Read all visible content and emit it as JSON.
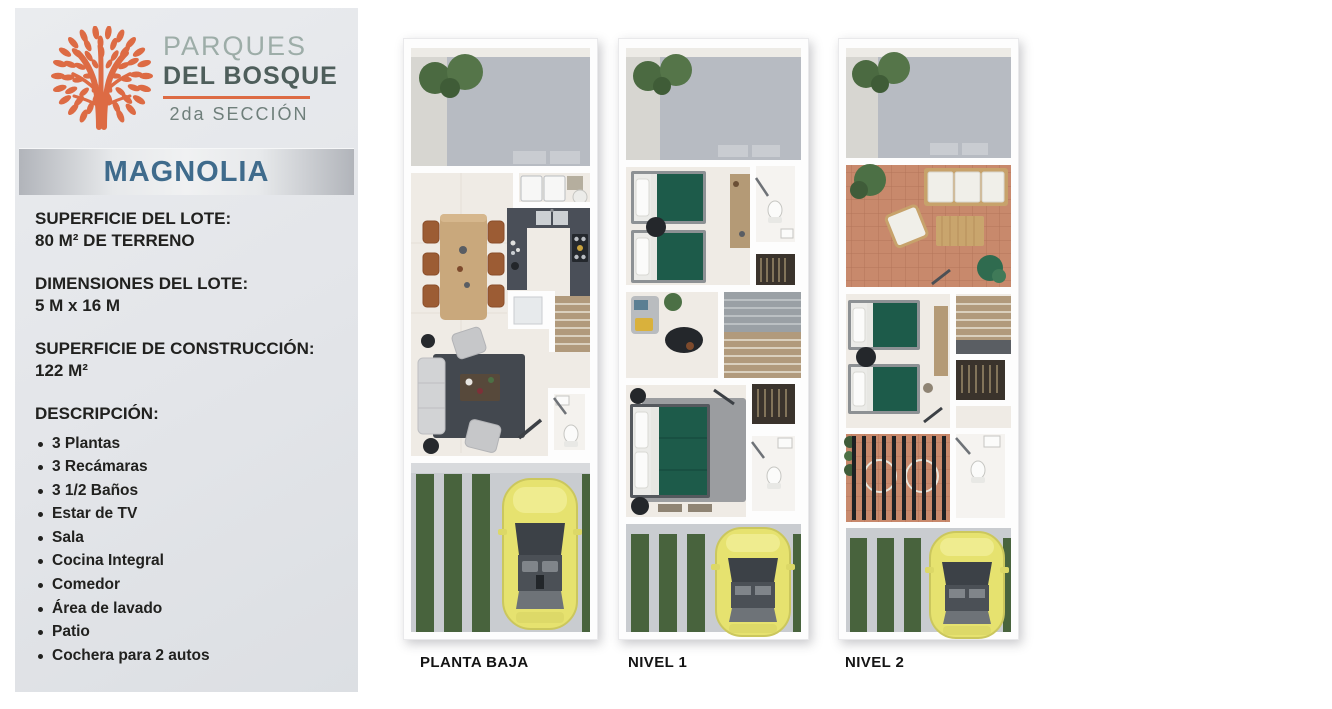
{
  "brand": {
    "name_line1": "PARQUES",
    "name_line2": "DEL BOSQUE",
    "section": "2da SECCIÓN",
    "logo_icon": "tree-icon",
    "colors": {
      "accent_orange": "#DD6B44",
      "brand_dark": "#4E5E5B",
      "brand_muted": "#9DADA8",
      "model_title_blue": "#3F6B8C",
      "panel_gray": "#E3E5E9"
    }
  },
  "model": {
    "title": "MAGNOLIA"
  },
  "specs": [
    {
      "label": "SUPERFICIE DEL LOTE:",
      "value": "80 M² DE TERRENO"
    },
    {
      "label": "DIMENSIONES DEL LOTE:",
      "value": "5 M x 16 M"
    },
    {
      "label": "SUPERFICIE DE CONSTRUCCIÓN:",
      "value": "122 M²"
    }
  ],
  "description": {
    "heading": "DESCRIPCIÓN:",
    "items": [
      "3 Plantas",
      "3 Recámaras",
      "3 1/2 Baños",
      "Estar de TV",
      "Sala",
      "Cocina Integral",
      "Comedor",
      "Área de lavado",
      "Patio",
      "Cochera para 2 autos"
    ]
  },
  "floorplans": [
    {
      "label": "PLANTA BAJA"
    },
    {
      "label": "NIVEL 1"
    },
    {
      "label": "NIVEL 2"
    }
  ]
}
